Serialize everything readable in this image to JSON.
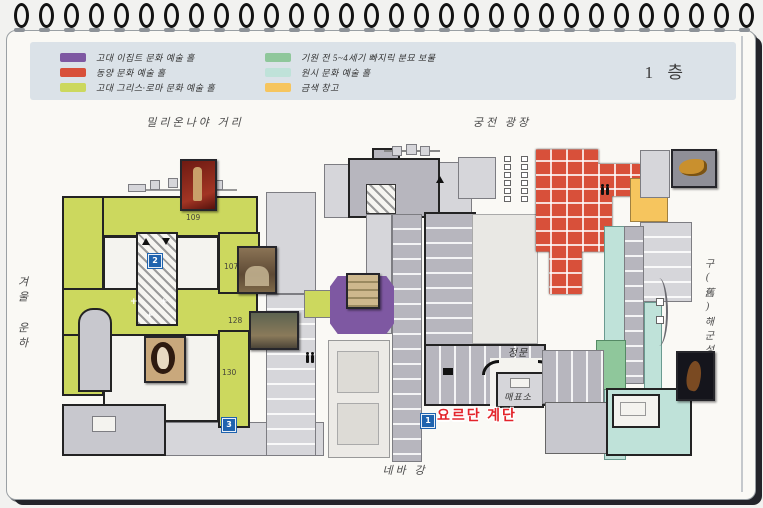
{
  "page": {
    "floor_label": "1 층"
  },
  "legend": {
    "items": [
      {
        "label": "고대 이집트 문화 예술 홀",
        "color": "#7e58a2"
      },
      {
        "label": "동양 문화 예술 홀",
        "color": "#d8503a"
      },
      {
        "label": "고대 그리스·로마 문화 예술 홀",
        "color": "#ccd85e"
      },
      {
        "label": "기원 전 5~4세기 빠지릭 분묘 보물",
        "color": "#8fc79b"
      },
      {
        "label": "원시 문화 예술 홀",
        "color": "#bfe2d9"
      },
      {
        "label": "금색 창고",
        "color": "#f6c55e"
      }
    ]
  },
  "labels": {
    "millionnaya_street": "밀리온나야 거리",
    "palace_square": "궁전 광장",
    "winter_canal": "겨울 운하",
    "old_admiralty": "구(舊)해군성",
    "neva_river": "네바 강",
    "main_gate": "정문",
    "ticket_office": "매표소",
    "jordan_staircase": "요르단 계단"
  },
  "rooms": [
    {
      "number": "109"
    },
    {
      "number": "107"
    },
    {
      "number": "128"
    },
    {
      "number": "130"
    }
  ],
  "markers": [
    {
      "number": "1"
    },
    {
      "number": "2"
    },
    {
      "number": "3"
    }
  ]
}
